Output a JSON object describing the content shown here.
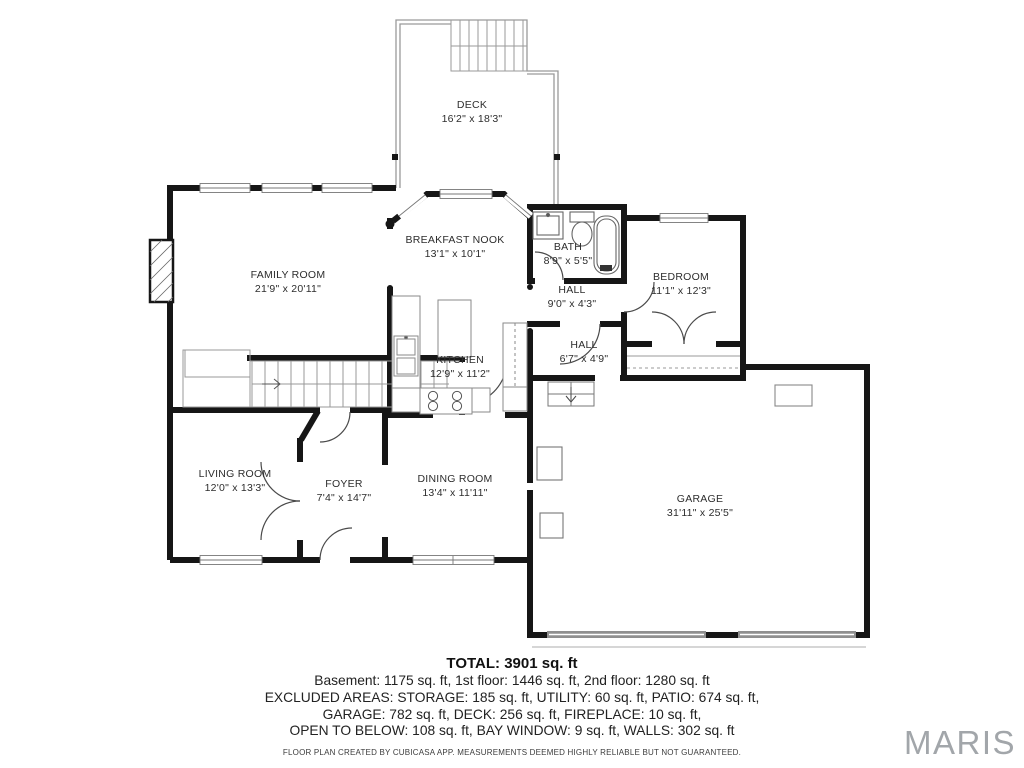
{
  "rooms": [
    {
      "id": "deck",
      "name": "DECK",
      "dims": "16'2\" x 18'3\""
    },
    {
      "id": "breakfast-nook",
      "name": "BREAKFAST NOOK",
      "dims": "13'1\" x 10'1\""
    },
    {
      "id": "bath",
      "name": "BATH",
      "dims": "8'9\" x 5'5\""
    },
    {
      "id": "bedroom",
      "name": "BEDROOM",
      "dims": "11'1\" x 12'3\""
    },
    {
      "id": "family-room",
      "name": "FAMILY ROOM",
      "dims": "21'9\" x 20'11\""
    },
    {
      "id": "hall-upper",
      "name": "HALL",
      "dims": "9'0\" x 4'3\""
    },
    {
      "id": "kitchen",
      "name": "KITCHEN",
      "dims": "12'9\" x 11'2\""
    },
    {
      "id": "hall-lower",
      "name": "HALL",
      "dims": "6'7\" x 4'9\""
    },
    {
      "id": "living-room",
      "name": "LIVING ROOM",
      "dims": "12'0\" x 13'3\""
    },
    {
      "id": "foyer",
      "name": "FOYER",
      "dims": "7'4\" x 14'7\""
    },
    {
      "id": "dining-room",
      "name": "DINING ROOM",
      "dims": "13'4\" x 11'11\""
    },
    {
      "id": "garage",
      "name": "GARAGE",
      "dims": "31'11\" x 25'5\""
    }
  ],
  "summary": {
    "total": "TOTAL: 3901 sq. ft",
    "line1": "Basement: 1175 sq. ft, 1st floor: 1446 sq. ft, 2nd floor: 1280 sq. ft",
    "line2": "EXCLUDED AREAS: STORAGE: 185 sq. ft, UTILITY: 60 sq. ft, PATIO: 674 sq. ft,",
    "line3": "GARAGE: 782 sq. ft, DECK: 256 sq. ft, FIREPLACE: 10 sq. ft,",
    "line4": "OPEN TO BELOW: 108 sq. ft, BAY WINDOW: 9 sq. ft, WALLS: 302 sq. ft",
    "disclaimer": "FLOOR PLAN CREATED BY CUBICASA APP. MEASUREMENTS DEEMED HIGHLY RELIABLE BUT NOT GUARANTEED."
  },
  "branding": {
    "logo": "MARIS"
  },
  "colors": {
    "wall": "#161616",
    "thin": "#8a8a8a",
    "label": "#2d2d2d",
    "logo_gray": "#a2a6aa"
  }
}
